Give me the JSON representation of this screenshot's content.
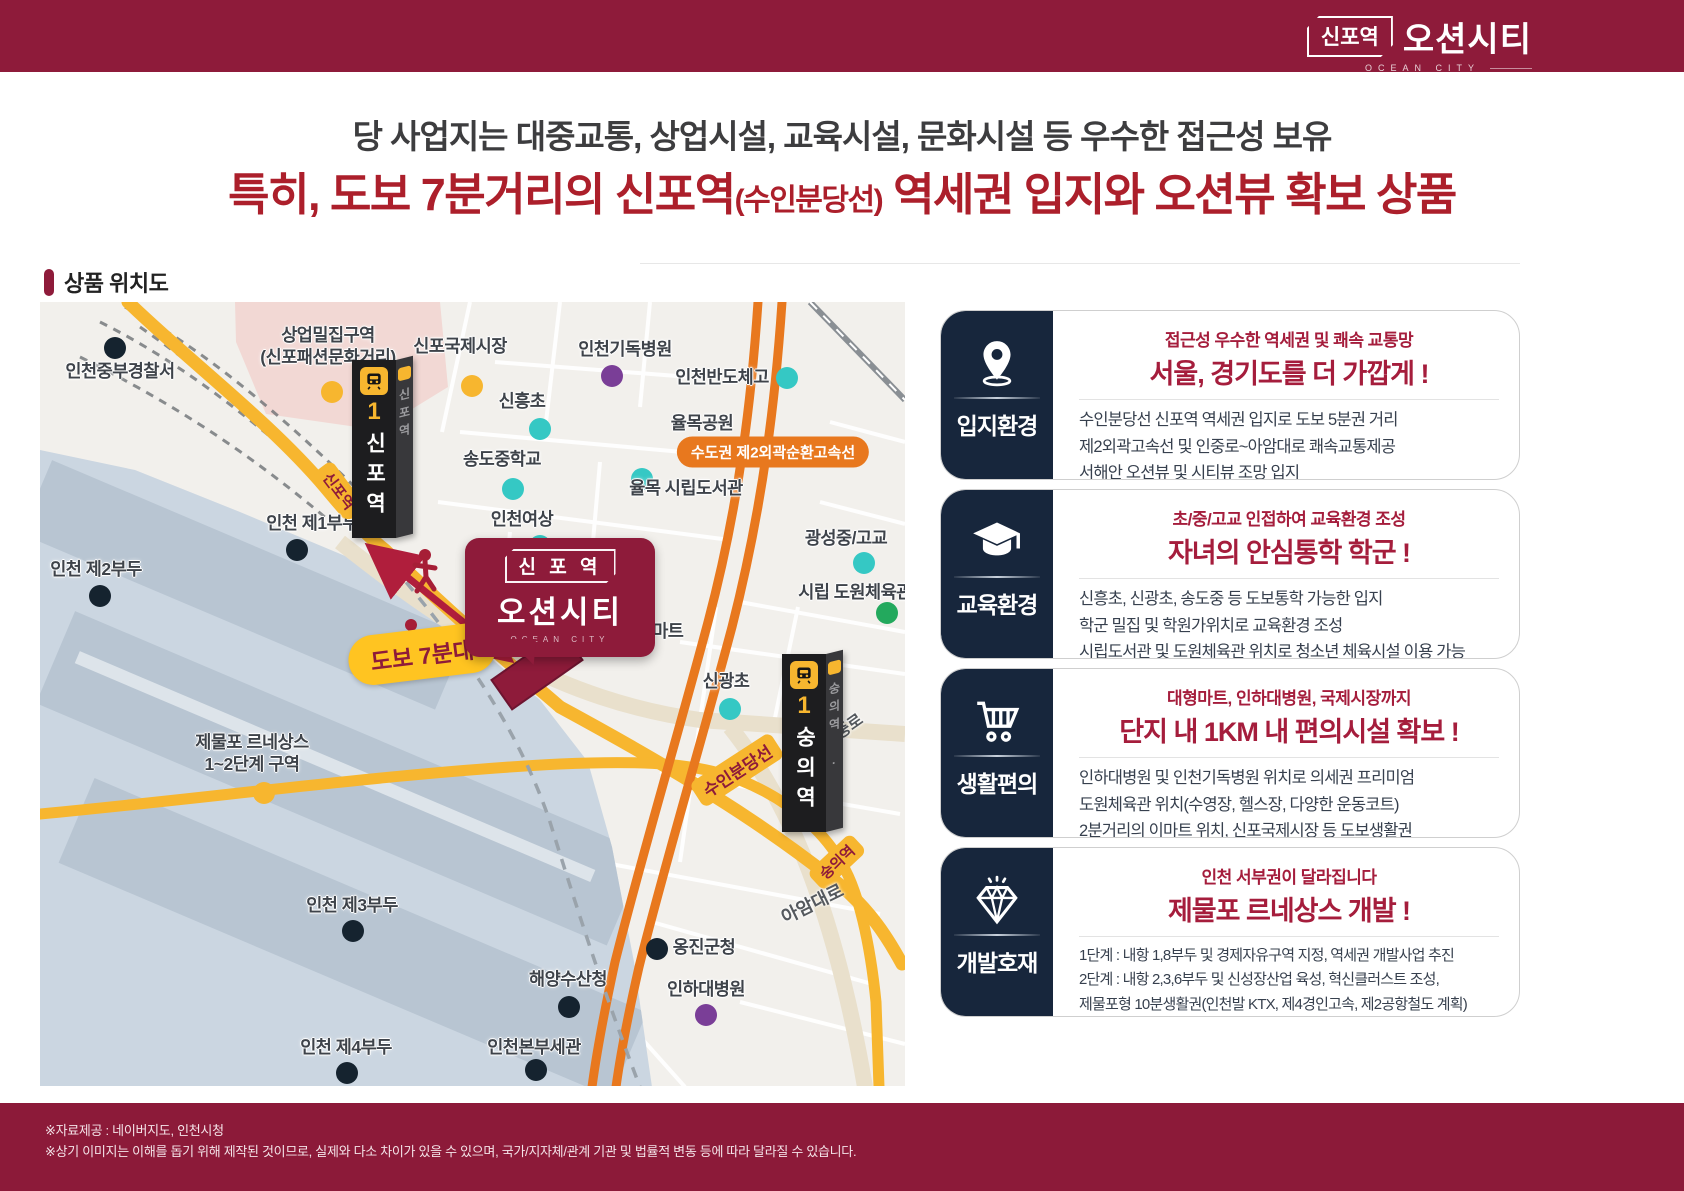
{
  "header": {
    "logo_station": "신포역",
    "logo_name": "오션시티",
    "logo_sub": "OCEAN CITY"
  },
  "headline": {
    "line1": "당 사업지는 대중교통, 상업시설, 교육시설, 문화시설 등 우수한 접근성 보유",
    "line2_prefix": "특히, 도보 7분거리의 신포역",
    "line2_small": "(수인분당선)",
    "line2_suffix": " 역세권 입지와 오션뷰 확보 상품"
  },
  "section": {
    "title": "상품 위치도"
  },
  "map": {
    "stations": [
      {
        "line": "1",
        "name": "신포역",
        "side": "신포역"
      },
      {
        "line": "1",
        "name": "숭의역",
        "side": "숭의역 ·"
      }
    ],
    "road_labels": {
      "sinpo_st": "신포역",
      "suin_line": "수인분당선",
      "sungui_st": "숭의역",
      "anjung": "안중로",
      "aam": "아암대로",
      "highway": "수도권 제2외곽순환고속선"
    },
    "walk_badge": "도보 7분대",
    "site": {
      "station": "신 포 역",
      "name": "오션시티",
      "sub": "OCEAN CITY"
    },
    "labels": [
      {
        "text": "인천중부경찰서",
        "dot": "navy"
      },
      {
        "text": "상업밀집구역",
        "text2": "(신포패션문화거리)",
        "dot": "yellow"
      },
      {
        "text": "신포국제시장",
        "dot": "yellow"
      },
      {
        "text": "신흥초",
        "dot": "teal"
      },
      {
        "text": "인천기독병원",
        "dot": "purple"
      },
      {
        "text": "인천반도체고",
        "dot": "teal"
      },
      {
        "text": "율목공원",
        "dot": "green"
      },
      {
        "text": "송도중학교",
        "dot": "teal"
      },
      {
        "text": "율목 시립도서관",
        "dot": "teal"
      },
      {
        "text": "인천여상",
        "dot": "teal"
      },
      {
        "text": "광성중/고교",
        "dot": "teal"
      },
      {
        "text": "시립 도원체육관",
        "dot": "green"
      },
      {
        "text": "이마트",
        "dot": "yellow"
      },
      {
        "text": "신광초",
        "dot": "teal"
      },
      {
        "text": "인천 제1부두",
        "dot": "navy"
      },
      {
        "text": "인천 제2부두",
        "dot": "navy"
      },
      {
        "text": "제물포 르네상스",
        "text2": "1~2단계 구역",
        "dot": "yellow"
      },
      {
        "text": "인천 제3부두",
        "dot": "navy"
      },
      {
        "text": "옹진군청",
        "dot": "navy"
      },
      {
        "text": "해양수산청",
        "dot": "navy"
      },
      {
        "text": "인하대병원",
        "dot": "purple"
      },
      {
        "text": "인천 제4부두",
        "dot": "navy"
      },
      {
        "text": "인천본부세관",
        "dot": "navy"
      }
    ]
  },
  "cards": [
    {
      "category": "입지환경",
      "icon": "location-pin-icon",
      "subtitle": "접근성 우수한 역세권 및 쾌속 교통망",
      "title": "서울, 경기도를 더 가깝게 !",
      "lines": [
        "수인분당선 신포역 역세권 입지로 도보 5분권 거리",
        "제2외곽고속선 및 인중로~아암대로 쾌속교통제공",
        "서해안 오션뷰 및 시티뷰 조망 입지"
      ]
    },
    {
      "category": "교육환경",
      "icon": "graduation-cap-icon",
      "subtitle": "초/중/고교 인접하여 교육환경 조성",
      "title": "자녀의 안심통학 학군 !",
      "lines": [
        "신흥초, 신광초, 송도중 등 도보통학 가능한 입지",
        "학군 밀집 및 학원가위치로 교육환경 조성",
        "시립도서관 및 도원체육관 위치로 청소년 체육시설 이용 가능"
      ]
    },
    {
      "category": "생활편의",
      "icon": "shopping-cart-icon",
      "subtitle": "대형마트, 인하대병원, 국제시장까지",
      "title": "단지 내 1KM 내 편의시설 확보 !",
      "lines": [
        "인하대병원 및 인천기독병원 위치로 의세권 프리미엄",
        "도원체육관 위치(수영장, 헬스장, 다양한 운동코트)",
        "2분거리의 이마트 위치, 신포국제시장 등 도보생활권"
      ]
    },
    {
      "category": "개발호재",
      "icon": "diamond-icon",
      "subtitle": "인천 서부권이 달라집니다",
      "title": "제물포 르네상스 개발 !",
      "lines": [
        "1단계 : 내항 1,8부두 및 경제자유구역 지정, 역세권 개발사업 추진",
        "2단계 : 내항 2,3,6부두 및 신성장산업 육성, 혁신클러스트 조성,",
        "제물포형 10분생활권(인천발 KTX, 제4경인고속, 제2공항철도 계획)"
      ]
    }
  ],
  "footer": {
    "line1": "※자료제공 : 네이버지도, 인천시청",
    "line2": "※상기 이미지는 이해를 돕기 위해 제작된 것이므로, 실제와 다소 차이가 있을 수 있으며, 국가/지자체/관계 기관 및 법률적 변동 등에 따라  달라질 수 있습니다."
  },
  "colors": {
    "brand_maroon": "#8E1B3A",
    "headline_red": "#AC1F2B",
    "card_navy": "#17263C",
    "card_red": "#A51D3C",
    "road_yellow": "#F7B62F",
    "highway_orange": "#E8781E",
    "water_blue": "#CBD6E1",
    "dot_teal": "#35C8C4",
    "dot_green": "#23A95D",
    "dot_purple": "#7A3E97",
    "dot_navy": "#15232F"
  }
}
